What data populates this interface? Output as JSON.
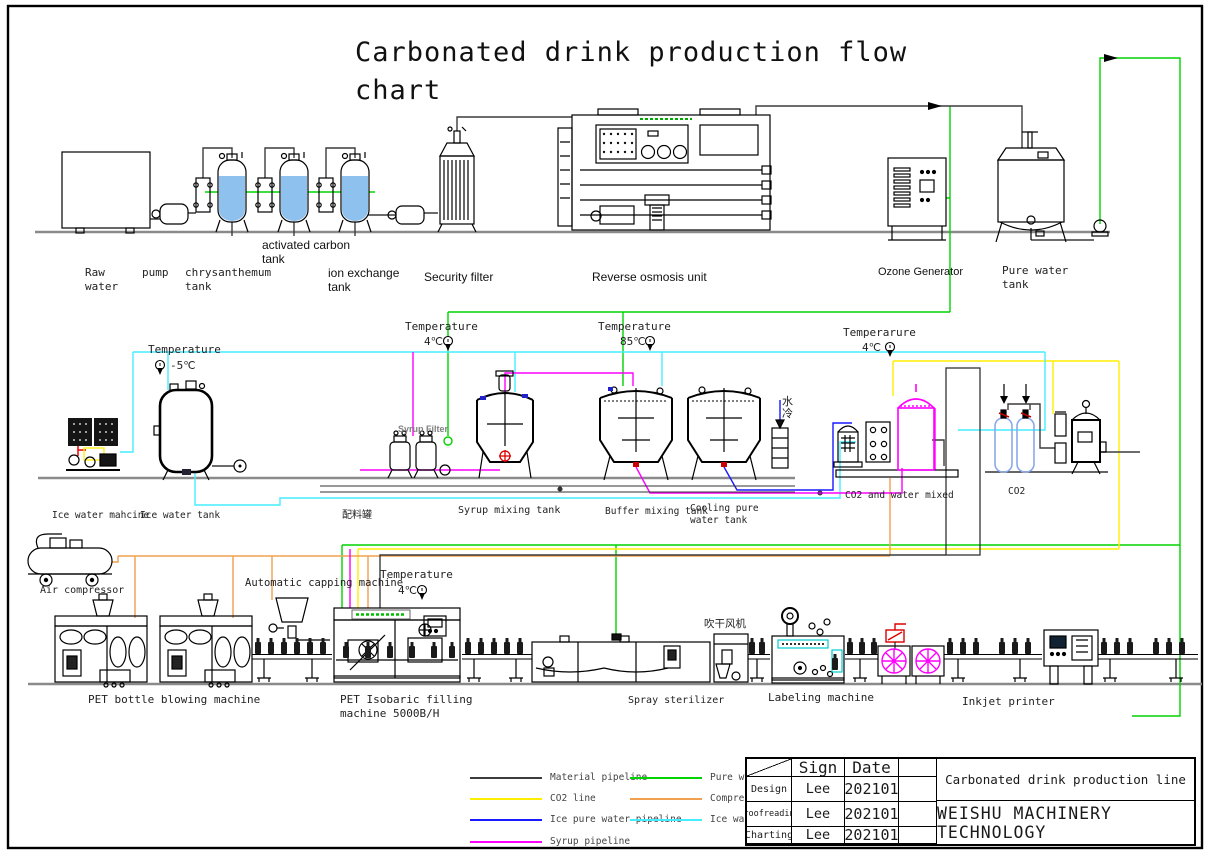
{
  "title": "Carbonated drink production flow chart",
  "top_row": {
    "raw_water": "Raw\nwater",
    "pump": "pump",
    "chrysanthemum_tank": "chrysanthemum\ntank",
    "activated_carbon_tank": "activated carbon\ntank",
    "ion_exchange_tank": "ion exchange\ntank",
    "security_filter": "Security filter",
    "reverse_osmosis_unit": "Reverse osmosis unit",
    "ozone_generator": "Ozone Generator",
    "pure_water_tank": "Pure water\ntank"
  },
  "middle_row": {
    "temp_ice": {
      "label": "Temperature",
      "value": "-5℃"
    },
    "temp_syrup": {
      "label": "Temperature",
      "value": "4℃"
    },
    "temp_buffer": {
      "label": "Temperature",
      "value": "85℃"
    },
    "temp_co2": {
      "label": "Temperarure",
      "value": "4℃"
    },
    "syrup_filter": "Syrup Filter",
    "water_cooling": "水冷",
    "ice_water_machine": "Ice water mahcine",
    "ice_water_tank": "Ice water tank",
    "batching_tank": "配料罐",
    "syrup_mixing_tank": "Syrup mixing tank",
    "buffer_mixing_tank": "Buffer mixing tank",
    "cooling_pure_water_tank": "Cooling pure\nwater tank",
    "co2_water_mixed": "CO2 and water mixed",
    "co2": "CO2"
  },
  "bottom_row": {
    "air_compressor": "Air compressor",
    "automatic_capping_machine": "Automatic capping machine",
    "temp_filling": {
      "label": "Temperature",
      "value": "4℃"
    },
    "blow_dry_fan": "吹干风机",
    "pet_bottle_blowing_machine": "PET bottle blowing machine",
    "pet_filling_machine": "PET Isobaric filling\nmachine 5000B/H",
    "spray_sterilizer": "Spray sterilizer",
    "labeling_machine": "Labeling machine",
    "inkjet_printer": "Inkjet printer"
  },
  "legend": {
    "items": [
      {
        "label": "Material pipeline",
        "color": "#3c3c3c"
      },
      {
        "label": "CO2 line",
        "color": "#ffee00"
      },
      {
        "label": "Ice pure water pipeline",
        "color": "#1a1aff"
      },
      {
        "label": "Syrup pipeline",
        "color": "#ff00ff"
      },
      {
        "label": "Pure water pipeline",
        "color": "#00d300"
      },
      {
        "label": "Compressed air pipeline",
        "color": "#f0a04f"
      },
      {
        "label": "Ice water pipeline",
        "color": "#44eeff"
      }
    ]
  },
  "title_block": {
    "col_sign": "Sign",
    "col_date": "Date",
    "rows": [
      {
        "role": "Design",
        "sign": "Lee",
        "date": "202101"
      },
      {
        "role": "Proofreading",
        "sign": "Lee",
        "date": "202101"
      },
      {
        "role": "Charting",
        "sign": "Lee",
        "date": "202101"
      }
    ],
    "project": "Carbonated drink production line",
    "company": "WEISHU MACHINERY TECHNOLOGY"
  }
}
